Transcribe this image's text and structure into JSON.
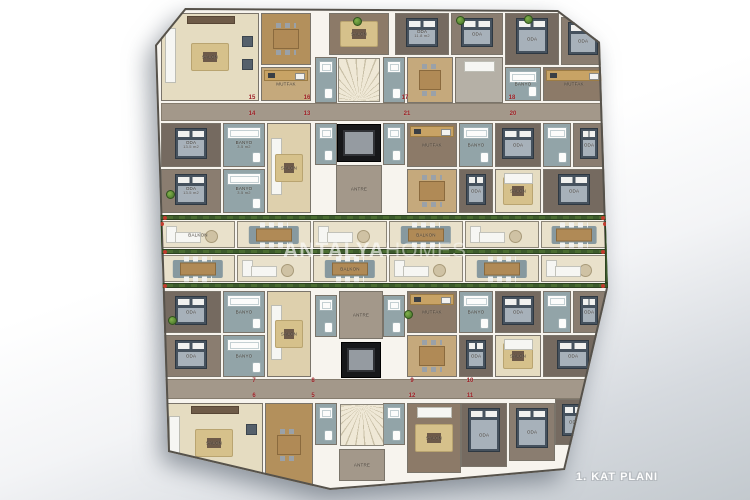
{
  "caption": "1. KAT PLANI",
  "watermark": {
    "part1": "ANTALYA",
    "part2": "HOMES"
  },
  "palette": {
    "background_top": "#ffffff",
    "background_bottom": "#c3c9ce",
    "corridor": "#a3988a",
    "wall": "#f7f4ee",
    "outline": "#56524b",
    "floor_cream": "#e5dcc1",
    "floor_wood": "#c5a97c",
    "floor_brown": "#8c7a68",
    "bathroom": "#92a4a8",
    "bed": "#46525e",
    "rug_gold": "#d6c18b",
    "balcony_floor": "#e9e1cb",
    "planter_green": "#3c5a2c",
    "flower_red": "#c23b2e",
    "elevator": "#17181a",
    "unit_number_red": "#9c1f24"
  },
  "plan": {
    "outline": [
      [
        185,
        8
      ],
      [
        558,
        10
      ],
      [
        600,
        42
      ],
      [
        608,
        288
      ],
      [
        565,
        470
      ],
      [
        430,
        482
      ],
      [
        330,
        490
      ],
      [
        168,
        452
      ],
      [
        155,
        45
      ]
    ],
    "corridors": [
      {
        "x": 162,
        "y": 104,
        "w": 442,
        "h": 16
      },
      {
        "x": 164,
        "y": 380,
        "w": 438,
        "h": 18
      }
    ],
    "stairs": [
      {
        "x": 338,
        "y": 58,
        "w": 42,
        "h": 44,
        "kind": "fan-up"
      },
      {
        "x": 340,
        "y": 404,
        "w": 44,
        "h": 42,
        "kind": "fan-down"
      }
    ],
    "elevators": [
      {
        "x": 337,
        "y": 124,
        "w": 44,
        "h": 38
      },
      {
        "x": 341,
        "y": 342,
        "w": 40,
        "h": 36
      }
    ],
    "rooms": [
      {
        "x": 162,
        "y": 14,
        "w": 96,
        "h": 86,
        "floor": "cream",
        "label": "SALON",
        "furn": [
          "sofaV",
          "rug",
          "chair1",
          "chair2",
          "tv"
        ]
      },
      {
        "x": 262,
        "y": 14,
        "w": 48,
        "h": 50,
        "floor": "wood2",
        "furn": [
          "dtable"
        ]
      },
      {
        "x": 262,
        "y": 68,
        "w": 48,
        "h": 32,
        "floor": "wood",
        "label": "MUTFAK",
        "furn": [
          "counter"
        ]
      },
      {
        "x": 330,
        "y": 14,
        "w": 58,
        "h": 40,
        "floor": "warm",
        "label": "SALON",
        "furn": [
          "rug"
        ]
      },
      {
        "x": 396,
        "y": 14,
        "w": 52,
        "h": 40,
        "floor": "carpet",
        "label": "ODA",
        "area": "11.8 m2",
        "furn": [
          "bed"
        ]
      },
      {
        "x": 452,
        "y": 14,
        "w": 50,
        "h": 40,
        "floor": "carpet2",
        "label": "ODA",
        "furn": [
          "bed"
        ]
      },
      {
        "x": 506,
        "y": 14,
        "w": 52,
        "h": 50,
        "floor": "carpet",
        "label": "ODA",
        "furn": [
          "bed"
        ]
      },
      {
        "x": 562,
        "y": 18,
        "w": 42,
        "h": 46,
        "floor": "carpet2",
        "label": "ODA",
        "furn": [
          "bed"
        ]
      },
      {
        "x": 316,
        "y": 58,
        "w": 20,
        "h": 44,
        "floor": "teal",
        "furn": [
          "tub",
          "wc"
        ]
      },
      {
        "x": 384,
        "y": 58,
        "w": 20,
        "h": 44,
        "floor": "teal",
        "furn": [
          "tub",
          "wc"
        ]
      },
      {
        "x": 408,
        "y": 58,
        "w": 44,
        "h": 44,
        "floor": "wood",
        "furn": [
          "dtable"
        ]
      },
      {
        "x": 456,
        "y": 58,
        "w": 46,
        "h": 44,
        "floor": "gray",
        "furn": [
          "sofaH"
        ]
      },
      {
        "x": 506,
        "y": 68,
        "w": 34,
        "h": 32,
        "floor": "teal",
        "label": "BANYO",
        "furn": [
          "tub",
          "wc"
        ]
      },
      {
        "x": 544,
        "y": 68,
        "w": 60,
        "h": 32,
        "floor": "warm",
        "label": "MUTFAK",
        "furn": [
          "counter"
        ]
      },
      {
        "x": 162,
        "y": 124,
        "w": 58,
        "h": 42,
        "floor": "carpet",
        "label": "ODA",
        "area": "13.5 m2",
        "furn": [
          "bed"
        ]
      },
      {
        "x": 162,
        "y": 170,
        "w": 58,
        "h": 42,
        "floor": "carpet2",
        "label": "ODA",
        "area": "13.5 m2",
        "furn": [
          "bed"
        ]
      },
      {
        "x": 224,
        "y": 124,
        "w": 40,
        "h": 42,
        "floor": "teal",
        "label": "BANYO",
        "area": "3.5 m2",
        "furn": [
          "tub",
          "wc"
        ]
      },
      {
        "x": 224,
        "y": 170,
        "w": 40,
        "h": 42,
        "floor": "teal",
        "label": "BANYO",
        "area": "3.5 m2",
        "furn": [
          "tub",
          "wc"
        ]
      },
      {
        "x": 268,
        "y": 124,
        "w": 42,
        "h": 88,
        "floor": "cream2",
        "label": "SALON",
        "furn": [
          "sofaV",
          "rug"
        ]
      },
      {
        "x": 316,
        "y": 124,
        "w": 20,
        "h": 40,
        "floor": "teal",
        "furn": [
          "tub",
          "wc"
        ]
      },
      {
        "x": 384,
        "y": 124,
        "w": 20,
        "h": 40,
        "floor": "teal",
        "furn": [
          "tub",
          "wc"
        ]
      },
      {
        "x": 337,
        "y": 166,
        "w": 44,
        "h": 46,
        "floor": "taupe",
        "label": "ANTRE"
      },
      {
        "x": 408,
        "y": 124,
        "w": 48,
        "h": 42,
        "floor": "warm",
        "label": "MUTFAK",
        "furn": [
          "counter"
        ]
      },
      {
        "x": 408,
        "y": 170,
        "w": 48,
        "h": 42,
        "floor": "wood",
        "furn": [
          "dtable"
        ]
      },
      {
        "x": 460,
        "y": 124,
        "w": 32,
        "h": 42,
        "floor": "teal",
        "label": "BANYO",
        "furn": [
          "tub",
          "wc"
        ]
      },
      {
        "x": 460,
        "y": 170,
        "w": 32,
        "h": 42,
        "floor": "carpet",
        "label": "ODA",
        "furn": [
          "bed"
        ]
      },
      {
        "x": 496,
        "y": 124,
        "w": 44,
        "h": 42,
        "floor": "carpet",
        "label": "ODA",
        "furn": [
          "bed"
        ]
      },
      {
        "x": 496,
        "y": 170,
        "w": 44,
        "h": 42,
        "floor": "cream",
        "label": "SALON",
        "furn": [
          "rug",
          "sofaH"
        ]
      },
      {
        "x": 544,
        "y": 124,
        "w": 26,
        "h": 42,
        "floor": "teal",
        "furn": [
          "tub",
          "wc"
        ]
      },
      {
        "x": 574,
        "y": 124,
        "w": 30,
        "h": 42,
        "floor": "carpet2",
        "label": "ODA",
        "furn": [
          "bed"
        ]
      },
      {
        "x": 544,
        "y": 170,
        "w": 60,
        "h": 42,
        "floor": "carpet",
        "label": "ODA",
        "furn": [
          "bed"
        ]
      },
      {
        "x": 162,
        "y": 292,
        "w": 58,
        "h": 40,
        "floor": "carpet",
        "label": "ODA",
        "furn": [
          "bed"
        ]
      },
      {
        "x": 162,
        "y": 336,
        "w": 58,
        "h": 40,
        "floor": "carpet2",
        "label": "ODA",
        "furn": [
          "bed"
        ]
      },
      {
        "x": 224,
        "y": 292,
        "w": 40,
        "h": 40,
        "floor": "teal",
        "label": "BANYO",
        "furn": [
          "tub",
          "wc"
        ]
      },
      {
        "x": 224,
        "y": 336,
        "w": 40,
        "h": 40,
        "floor": "teal",
        "label": "BANYO",
        "furn": [
          "tub",
          "wc"
        ]
      },
      {
        "x": 268,
        "y": 292,
        "w": 42,
        "h": 84,
        "floor": "cream2",
        "label": "SALON",
        "furn": [
          "sofaV",
          "rug"
        ]
      },
      {
        "x": 316,
        "y": 296,
        "w": 20,
        "h": 40,
        "floor": "teal",
        "furn": [
          "tub",
          "wc"
        ]
      },
      {
        "x": 384,
        "y": 296,
        "w": 20,
        "h": 40,
        "floor": "teal",
        "furn": [
          "tub",
          "wc"
        ]
      },
      {
        "x": 340,
        "y": 292,
        "w": 42,
        "h": 46,
        "floor": "taupe",
        "label": "ANTRE"
      },
      {
        "x": 408,
        "y": 292,
        "w": 48,
        "h": 40,
        "floor": "warm",
        "label": "MUTFAK",
        "furn": [
          "counter"
        ]
      },
      {
        "x": 408,
        "y": 336,
        "w": 48,
        "h": 40,
        "floor": "wood",
        "furn": [
          "dtable"
        ]
      },
      {
        "x": 460,
        "y": 292,
        "w": 32,
        "h": 40,
        "floor": "teal",
        "label": "BANYO",
        "furn": [
          "tub",
          "wc"
        ]
      },
      {
        "x": 460,
        "y": 336,
        "w": 32,
        "h": 40,
        "floor": "carpet",
        "label": "ODA",
        "furn": [
          "bed"
        ]
      },
      {
        "x": 496,
        "y": 292,
        "w": 44,
        "h": 40,
        "floor": "carpet",
        "label": "ODA",
        "furn": [
          "bed"
        ]
      },
      {
        "x": 496,
        "y": 336,
        "w": 44,
        "h": 40,
        "floor": "cream",
        "label": "SALON",
        "furn": [
          "rug",
          "sofaH"
        ]
      },
      {
        "x": 544,
        "y": 292,
        "w": 26,
        "h": 40,
        "floor": "teal",
        "furn": [
          "tub",
          "wc"
        ]
      },
      {
        "x": 574,
        "y": 292,
        "w": 30,
        "h": 40,
        "floor": "carpet2",
        "label": "ODA",
        "furn": [
          "bed"
        ]
      },
      {
        "x": 544,
        "y": 336,
        "w": 58,
        "h": 40,
        "floor": "carpet",
        "label": "ODA",
        "furn": [
          "bed"
        ]
      },
      {
        "x": 316,
        "y": 404,
        "w": 20,
        "h": 40,
        "floor": "teal",
        "furn": [
          "tub",
          "wc"
        ]
      },
      {
        "x": 384,
        "y": 404,
        "w": 20,
        "h": 40,
        "floor": "teal",
        "furn": [
          "tub",
          "wc"
        ]
      },
      {
        "x": 166,
        "y": 404,
        "w": 96,
        "h": 78,
        "floor": "cream",
        "label": "SALON",
        "furn": [
          "sofaV",
          "rug",
          "chair1",
          "tv"
        ]
      },
      {
        "x": 266,
        "y": 404,
        "w": 46,
        "h": 82,
        "floor": "wood2",
        "furn": [
          "dtable"
        ]
      },
      {
        "x": 340,
        "y": 450,
        "w": 44,
        "h": 30,
        "floor": "taupe",
        "label": "ANTRE"
      },
      {
        "x": 408,
        "y": 404,
        "w": 52,
        "h": 68,
        "floor": "warm",
        "label": "SALON",
        "furn": [
          "rug",
          "sofaH"
        ]
      },
      {
        "x": 462,
        "y": 404,
        "w": 44,
        "h": 62,
        "floor": "carpet",
        "label": "ODA",
        "furn": [
          "bed"
        ]
      },
      {
        "x": 510,
        "y": 404,
        "w": 44,
        "h": 56,
        "floor": "carpet2",
        "label": "ODA",
        "furn": [
          "bed"
        ]
      },
      {
        "x": 556,
        "y": 400,
        "w": 36,
        "h": 44,
        "floor": "carpet",
        "label": "ODA",
        "furn": [
          "bed"
        ]
      }
    ],
    "planters": [
      {
        "x": 160,
        "y": 215,
        "w": 448,
        "h": 5
      },
      {
        "x": 160,
        "y": 249,
        "w": 448,
        "h": 5
      },
      {
        "x": 160,
        "y": 283,
        "w": 448,
        "h": 5
      },
      {
        "x": 157,
        "y": 221,
        "w": 5,
        "h": 62
      },
      {
        "x": 605,
        "y": 221,
        "w": 5,
        "h": 62
      }
    ],
    "balconies": [
      {
        "x": 162,
        "y": 222,
        "w": 72,
        "h": 25,
        "type": "sofa",
        "label": "BALKON"
      },
      {
        "x": 238,
        "y": 222,
        "w": 72,
        "h": 25,
        "type": "dining"
      },
      {
        "x": 314,
        "y": 222,
        "w": 72,
        "h": 25,
        "type": "sofa"
      },
      {
        "x": 390,
        "y": 222,
        "w": 72,
        "h": 25,
        "type": "dining",
        "label": "BALKON"
      },
      {
        "x": 466,
        "y": 222,
        "w": 72,
        "h": 25,
        "type": "sofa"
      },
      {
        "x": 542,
        "y": 222,
        "w": 64,
        "h": 25,
        "type": "dining"
      },
      {
        "x": 162,
        "y": 256,
        "w": 72,
        "h": 25,
        "type": "dining"
      },
      {
        "x": 238,
        "y": 256,
        "w": 72,
        "h": 25,
        "type": "sofa"
      },
      {
        "x": 314,
        "y": 256,
        "w": 72,
        "h": 25,
        "type": "dining",
        "label": "BALKON"
      },
      {
        "x": 390,
        "y": 256,
        "w": 72,
        "h": 25,
        "type": "sofa"
      },
      {
        "x": 466,
        "y": 256,
        "w": 72,
        "h": 25,
        "type": "dining"
      },
      {
        "x": 542,
        "y": 256,
        "w": 64,
        "h": 25,
        "type": "sofa"
      }
    ],
    "unit_numbers": [
      {
        "x": 252,
        "y": 98,
        "n": "15"
      },
      {
        "x": 307,
        "y": 98,
        "n": "16"
      },
      {
        "x": 405,
        "y": 98,
        "n": "17"
      },
      {
        "x": 512,
        "y": 98,
        "n": "18"
      },
      {
        "x": 252,
        "y": 114,
        "n": "14"
      },
      {
        "x": 307,
        "y": 114,
        "n": "13"
      },
      {
        "x": 407,
        "y": 114,
        "n": "21"
      },
      {
        "x": 513,
        "y": 114,
        "n": "20"
      },
      {
        "x": 254,
        "y": 381,
        "n": "7"
      },
      {
        "x": 313,
        "y": 381,
        "n": "8"
      },
      {
        "x": 412,
        "y": 381,
        "n": "9"
      },
      {
        "x": 470,
        "y": 381,
        "n": "10"
      },
      {
        "x": 254,
        "y": 396,
        "n": "6"
      },
      {
        "x": 313,
        "y": 396,
        "n": "5"
      },
      {
        "x": 412,
        "y": 396,
        "n": "12"
      },
      {
        "x": 470,
        "y": 396,
        "n": "11"
      }
    ],
    "trees": [
      {
        "x": 163,
        "y": 16
      },
      {
        "x": 353,
        "y": 17
      },
      {
        "x": 456,
        "y": 16
      },
      {
        "x": 524,
        "y": 15
      },
      {
        "x": 166,
        "y": 190
      },
      {
        "x": 404,
        "y": 310
      },
      {
        "x": 168,
        "y": 316
      }
    ]
  }
}
